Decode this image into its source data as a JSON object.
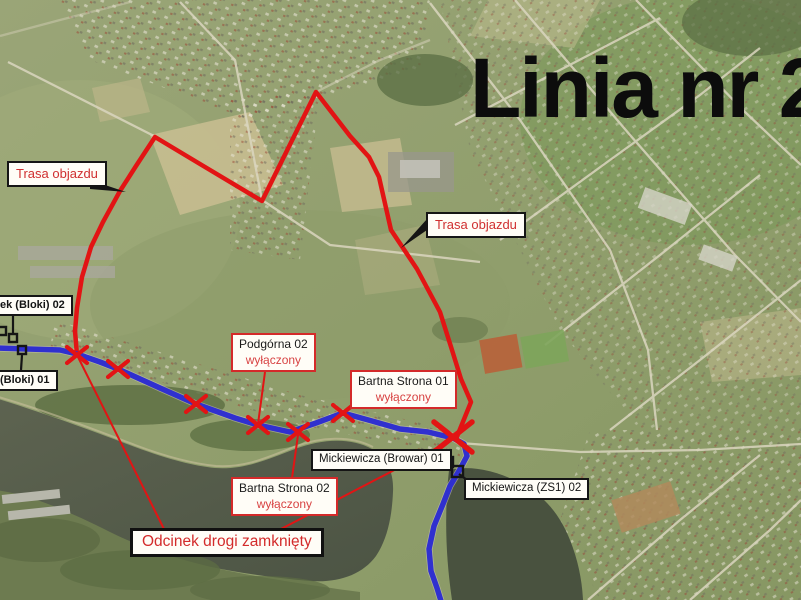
{
  "title": "Linia nr 2",
  "legend": {
    "detour_left": "Trasa objazdu",
    "detour_right": "Trasa objazdu",
    "closed_section": "Odcinek drogi zamknięty"
  },
  "stops": [
    {
      "name": "ek (Bloki) 02",
      "status": ""
    },
    {
      "name": "(Bloki) 01",
      "status": ""
    },
    {
      "name": "Podgórna 02",
      "status": "wyłączony"
    },
    {
      "name": "Bartna Strona 01",
      "status": "wyłączony"
    },
    {
      "name": "Bartna Strona 02",
      "status": "wyłączony"
    },
    {
      "name": "Mickiewicza (Browar) 01",
      "status": ""
    },
    {
      "name": "Mickiewicza (ZS1) 02",
      "status": ""
    }
  ],
  "colors": {
    "bus_line": "#3030cf",
    "detour_route": "#e21414",
    "closed_x_mark": "#e21414",
    "label_red_text": "#d32b2b",
    "label_black_text": "#141414",
    "water": "#59604d",
    "title_text": "#0c0c0c"
  }
}
